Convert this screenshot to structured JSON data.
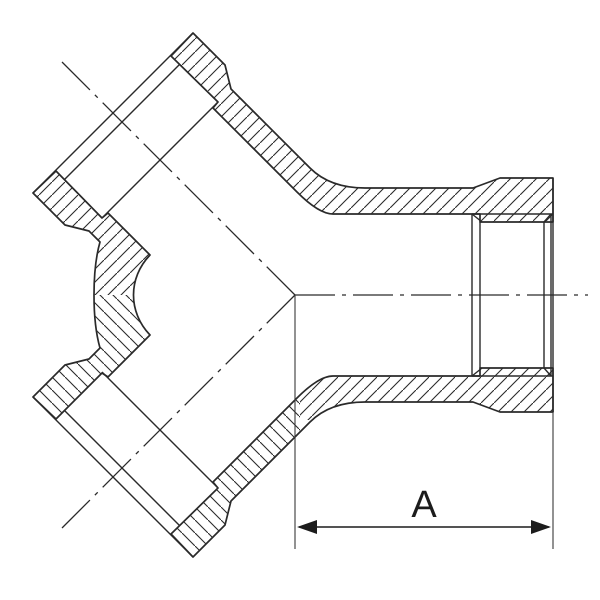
{
  "dimension": {
    "label": "A"
  },
  "colors": {
    "background": "#ffffff",
    "line": "#2a2a2a",
    "dimension": "#1c1c1c"
  }
}
